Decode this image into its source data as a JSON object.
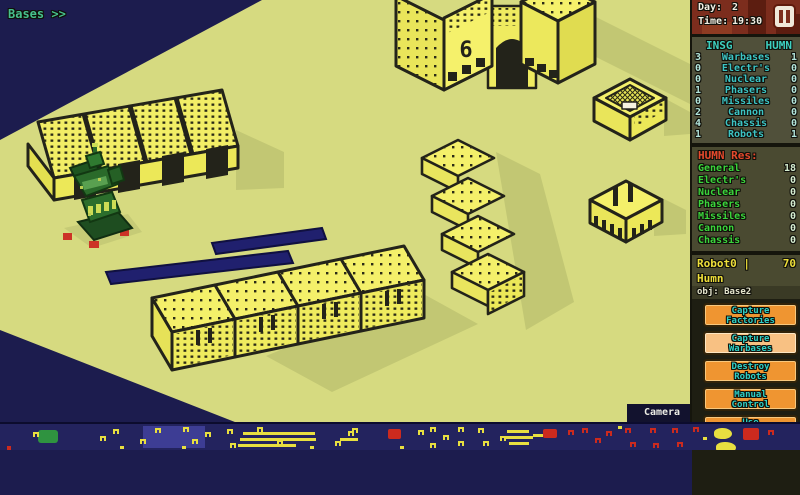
{
  "hud": {
    "bases_label": "Bases >>",
    "camera_label": "Camera",
    "day_label": "Day:",
    "day_value": "2",
    "time_label": "Time:",
    "time_value": "19:30"
  },
  "stats_table": {
    "col_left": "INSG",
    "col_right": "HUMN",
    "rows": [
      {
        "label": "Warbases",
        "insg": "3",
        "humn": "1"
      },
      {
        "label": "Electr's",
        "insg": "0",
        "humn": "0"
      },
      {
        "label": "Nuclear",
        "insg": "0",
        "humn": "0"
      },
      {
        "label": "Phasers",
        "insg": "1",
        "humn": "0"
      },
      {
        "label": "Missiles",
        "insg": "0",
        "humn": "0"
      },
      {
        "label": "Cannon",
        "insg": "2",
        "humn": "0"
      },
      {
        "label": "Chassis",
        "insg": "4",
        "humn": "0"
      },
      {
        "label": "Robots",
        "insg": "1",
        "humn": "1"
      }
    ]
  },
  "resources": {
    "title": "HUMN Res:",
    "rows": [
      {
        "label": "General",
        "value": "18"
      },
      {
        "label": "Electr's",
        "value": "0"
      },
      {
        "label": "Nuclear",
        "value": "0"
      },
      {
        "label": "Phasers",
        "value": "0"
      },
      {
        "label": "Missiles",
        "value": "0"
      },
      {
        "label": "Cannon",
        "value": "0"
      },
      {
        "label": "Chassis",
        "value": "0"
      }
    ]
  },
  "robot_panel": {
    "title": "Robot0 | Humn",
    "hp": "70",
    "objective": "obj: Base2",
    "buttons": [
      {
        "label1": "Capture",
        "label2": "Factories"
      },
      {
        "label1": "Capture",
        "label2": "Warbases"
      },
      {
        "label1": "Destroy",
        "label2": "Robots"
      },
      {
        "label1": "Manual",
        "label2": "Control"
      },
      {
        "label1": "Use",
        "label2": "Nuclear"
      }
    ]
  },
  "map": {
    "building_number": "6"
  },
  "colors": {
    "ground": "#d6da80",
    "building_yellow": "#f2ee68",
    "outline": "#23231a",
    "navy": "#1c1c4e",
    "minimap_bg": "#23235e",
    "accent_teal": "#3cc4c4",
    "accent_green": "#3bd43b",
    "accent_red": "#e4492c",
    "button_orange": "#ef9531",
    "button_active": "#f8c183",
    "title_yellow": "#eedf3a",
    "robot_green": "#2a6a2a"
  },
  "minimap": {
    "marks": [
      {
        "t": "g",
        "x": 38,
        "y": 6
      },
      {
        "t": "yn",
        "x": 33,
        "y": 8
      },
      {
        "t": "yn",
        "x": 100,
        "y": 12
      },
      {
        "t": "yn",
        "x": 113,
        "y": 5
      },
      {
        "t": "yn",
        "x": 140,
        "y": 15
      },
      {
        "t": "yn",
        "x": 155,
        "y": 4
      },
      {
        "t": "yn",
        "x": 183,
        "y": 3
      },
      {
        "t": "yn",
        "x": 192,
        "y": 15
      },
      {
        "t": "yd",
        "x": 120,
        "y": 22
      },
      {
        "t": "yn",
        "x": 205,
        "y": 8
      },
      {
        "t": "yn",
        "x": 227,
        "y": 5
      },
      {
        "t": "yn",
        "x": 230,
        "y": 19
      },
      {
        "t": "yn",
        "x": 257,
        "y": 3
      },
      {
        "t": "yn",
        "x": 277,
        "y": 16
      },
      {
        "t": "yb",
        "x": 243,
        "y": 8,
        "w": 72
      },
      {
        "t": "yb",
        "x": 240,
        "y": 14,
        "w": 76
      },
      {
        "t": "yb",
        "x": 238,
        "y": 20,
        "w": 58
      },
      {
        "t": "yn",
        "x": 348,
        "y": 7
      },
      {
        "t": "yb",
        "x": 340,
        "y": 14,
        "w": 18
      },
      {
        "t": "yn",
        "x": 335,
        "y": 17
      },
      {
        "t": "yn",
        "x": 352,
        "y": 4
      },
      {
        "t": "rb",
        "x": 388,
        "y": 5,
        "w": 13,
        "h": 10
      },
      {
        "t": "yn",
        "x": 418,
        "y": 6
      },
      {
        "t": "yn",
        "x": 430,
        "y": 3
      },
      {
        "t": "yn",
        "x": 430,
        "y": 19
      },
      {
        "t": "yn",
        "x": 443,
        "y": 11
      },
      {
        "t": "yn",
        "x": 458,
        "y": 3
      },
      {
        "t": "yn",
        "x": 458,
        "y": 17
      },
      {
        "t": "yn",
        "x": 478,
        "y": 4
      },
      {
        "t": "yn",
        "x": 483,
        "y": 17
      },
      {
        "t": "yn",
        "x": 500,
        "y": 12
      },
      {
        "t": "yb",
        "x": 507,
        "y": 6,
        "w": 22
      },
      {
        "t": "yb",
        "x": 505,
        "y": 12,
        "w": 28
      },
      {
        "t": "yb",
        "x": 509,
        "y": 18,
        "w": 20
      },
      {
        "t": "yb",
        "x": 533,
        "y": 10,
        "w": 10
      },
      {
        "t": "rb",
        "x": 543,
        "y": 5,
        "w": 14,
        "h": 9
      },
      {
        "t": "rn",
        "x": 568,
        "y": 6
      },
      {
        "t": "rn",
        "x": 582,
        "y": 4
      },
      {
        "t": "rn",
        "x": 595,
        "y": 14
      },
      {
        "t": "rn",
        "x": 606,
        "y": 7
      },
      {
        "t": "rn",
        "x": 625,
        "y": 4
      },
      {
        "t": "rn",
        "x": 630,
        "y": 18
      },
      {
        "t": "rn",
        "x": 650,
        "y": 4
      },
      {
        "t": "rn",
        "x": 653,
        "y": 19
      },
      {
        "t": "rn",
        "x": 672,
        "y": 4
      },
      {
        "t": "rn",
        "x": 677,
        "y": 18
      },
      {
        "t": "rn",
        "x": 693,
        "y": 3
      },
      {
        "t": "yd",
        "x": 618,
        "y": 2
      },
      {
        "t": "yd",
        "x": 703,
        "y": 13
      },
      {
        "t": "yd",
        "x": 310,
        "y": 22
      },
      {
        "t": "pac",
        "x": 714,
        "y": 4,
        "w": 18,
        "h": 11
      },
      {
        "t": "pac",
        "x": 716,
        "y": 18,
        "w": 20,
        "h": 11
      },
      {
        "t": "rb",
        "x": 743,
        "y": 4,
        "w": 16,
        "h": 12
      },
      {
        "t": "rn",
        "x": 768,
        "y": 6
      },
      {
        "t": "rd",
        "x": 7,
        "y": 22
      },
      {
        "t": "yd",
        "x": 400,
        "y": 22
      },
      {
        "t": "yd",
        "x": 182,
        "y": 22
      }
    ]
  }
}
